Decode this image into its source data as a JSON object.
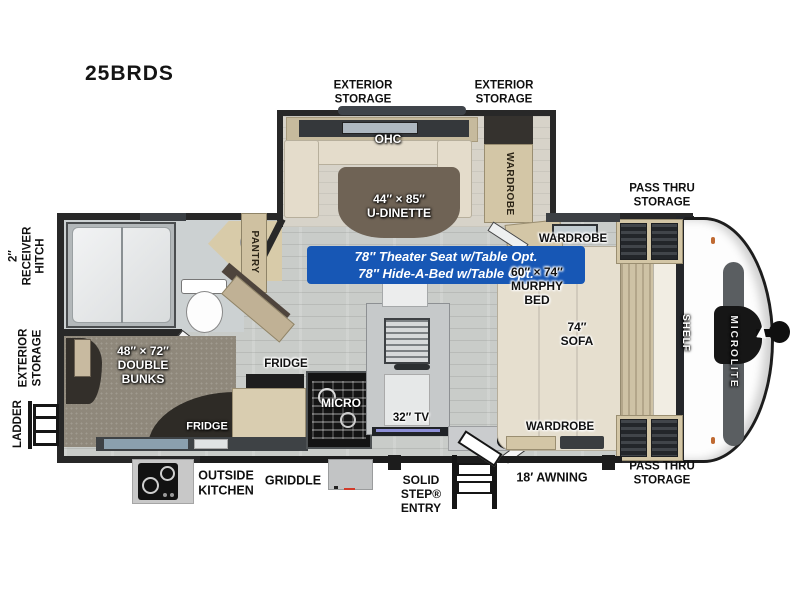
{
  "title": "25BRDS",
  "brand": "MICROLITE",
  "colors": {
    "wall": "#282828",
    "floor": "#c9ccc9",
    "cabinet_tan": "#d3c6a6",
    "upholstery_cream": "#e4dccb",
    "option_box_blue": "#1757b5",
    "cap_white": "#fdfdfd",
    "cap_stripe_gray": "#5a5e61"
  },
  "exterior_labels": {
    "exterior_storage_top_left": "EXTERIOR\nSTORAGE",
    "exterior_storage_top_right": "EXTERIOR\nSTORAGE",
    "pass_thru_top": "PASS THRU\nSTORAGE",
    "pass_thru_bottom": "PASS THRU\nSTORAGE",
    "receiver_hitch": "2″\nRECEIVER\nHITCH",
    "exterior_storage_rear": "EXTERIOR\nSTORAGE",
    "ladder": "LADDER",
    "outside_kitchen": "OUTSIDE\nKITCHEN",
    "griddle": "GRIDDLE",
    "solid_step_entry": "SOLID\nSTEP®\nENTRY",
    "awning": "18′ AWNING"
  },
  "interior_labels": {
    "ohc": "OHC",
    "u_dinette": "44″ × 85″\nU-DINETTE",
    "wardrobe_slide": "WARDROBE",
    "pantry": "PANTRY",
    "wardrobe_top": "WARDROBE",
    "murphy_bed": "60″ × 74″\nMURPHY\nBED",
    "sofa": "74″\nSOFA",
    "shelf": "SHELF",
    "wardrobe_bottom": "WARDROBE",
    "double_bunks": "48″ × 72″\nDOUBLE\nBUNKS",
    "fridge_bunk": "FRIDGE",
    "fridge_kitchen": "FRIDGE",
    "micro": "MICRO",
    "tv": "32″ TV"
  },
  "options_box": {
    "line1": "78″ Theater Seat w/Table Opt.",
    "line2": "78″ Hide-A-Bed w/Table Opt."
  }
}
